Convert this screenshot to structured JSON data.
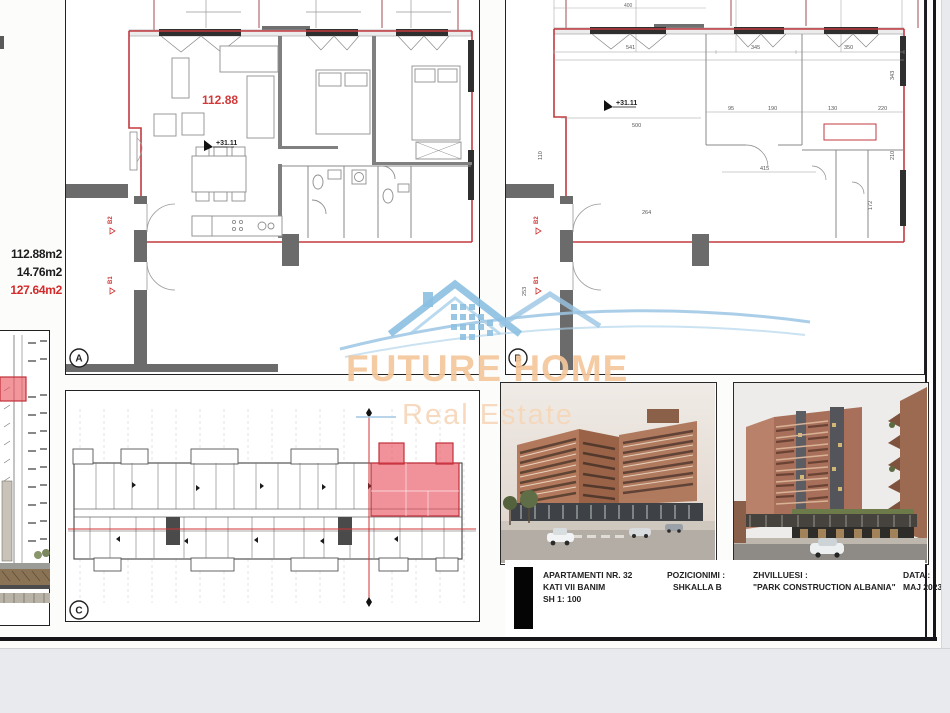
{
  "left_column": {
    "areas": [
      {
        "label": "112.88m2"
      },
      {
        "label": "14.76m2"
      },
      {
        "label": "127.64m2"
      }
    ]
  },
  "panel_a": {
    "label": "A",
    "area_text": "112.88",
    "elevation_text": "+31.11",
    "marker_b2": "B2",
    "marker_b1": "B1"
  },
  "panel_b": {
    "label": "B",
    "elevation_text": "+31.11",
    "marker_b2": "B2",
    "marker_b1": "B1",
    "dims": [
      "541",
      "345",
      "350",
      "400",
      "500",
      "415",
      "264",
      "110",
      "253",
      "172",
      "343",
      "210",
      "95",
      "190",
      "130",
      "220"
    ]
  },
  "panel_c": {
    "label": "C"
  },
  "watermark": {
    "line1": "FUTURE HOME",
    "line2": "Real Estate"
  },
  "title_block": {
    "col1_line1": "APARTAMENTI NR. 32",
    "col1_line2": "KATI VII BANIM",
    "col1_line3": "SH 1: 100",
    "col2_title": "POZICIONIMI :",
    "col2_value": "SHKALLA  B",
    "col3_title": "ZHVILLUESI :",
    "col3_value": "\"PARK CONSTRUCTION ALBANIA\"",
    "col4_title": "DATA :",
    "col4_value": "MAJ 2023"
  }
}
